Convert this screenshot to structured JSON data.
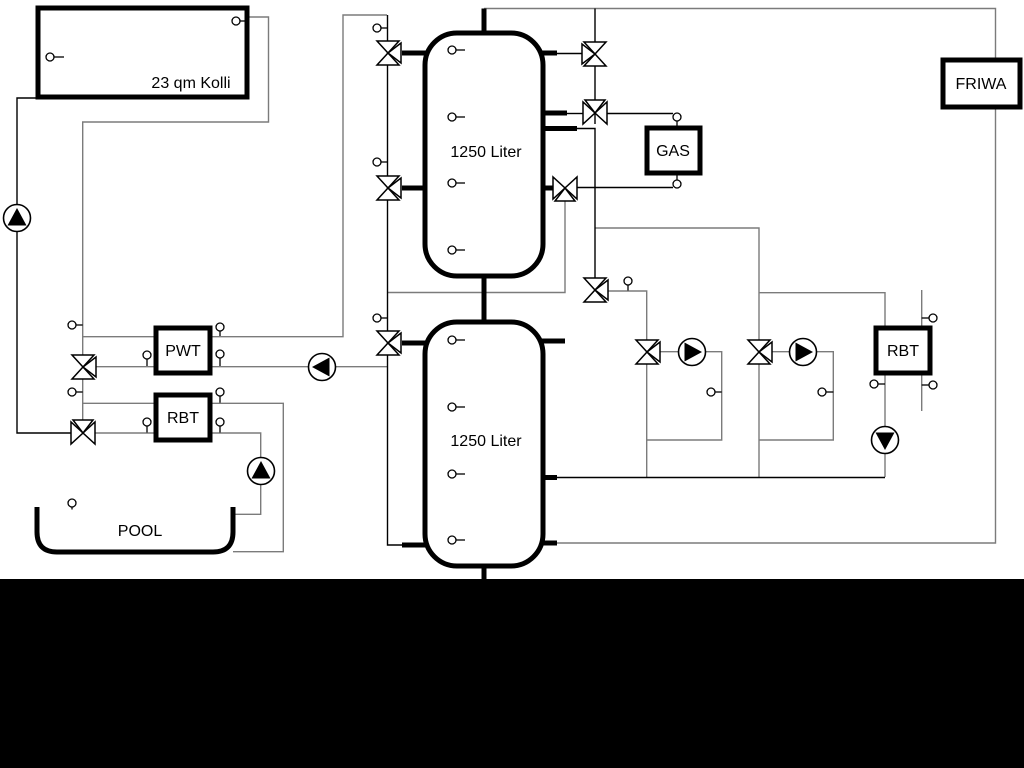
{
  "diagram": {
    "type": "hydraulic-schematic",
    "labels": {
      "collector": "23 qm Kolli",
      "buffer_tank_top": "1250 Liter",
      "buffer_tank_bottom": "1250 Liter",
      "gas_boiler": "GAS",
      "friwa": "FRIWA",
      "pwt": "PWT",
      "rbt_left": "RBT",
      "rbt_right": "RBT",
      "pool": "POOL"
    },
    "colors": {
      "pipe_black": "#000000",
      "pipe_gray": "#7b7b7b",
      "symbol_fill": "#ffffff",
      "background": "#ffffff",
      "bottom_bar": "#000000"
    },
    "components": {
      "valves": [
        "solar-charge-valve-top",
        "solar-charge-valve-mid",
        "solar-charge-valve-lower",
        "tank-top-right-valve",
        "gas-supply-valve",
        "gas-return-valve",
        "tank-link-valve",
        "heating-circuit-1-valve",
        "heating-circuit-2-valve",
        "pwt-mixing-valve",
        "pool-mixing-valve"
      ],
      "pumps": [
        "solar-pump",
        "pwt-pump",
        "heating-circuit-1-pump",
        "heating-circuit-2-pump",
        "rbt-right-pump",
        "pool-pump"
      ],
      "sensor_count": 29
    }
  }
}
